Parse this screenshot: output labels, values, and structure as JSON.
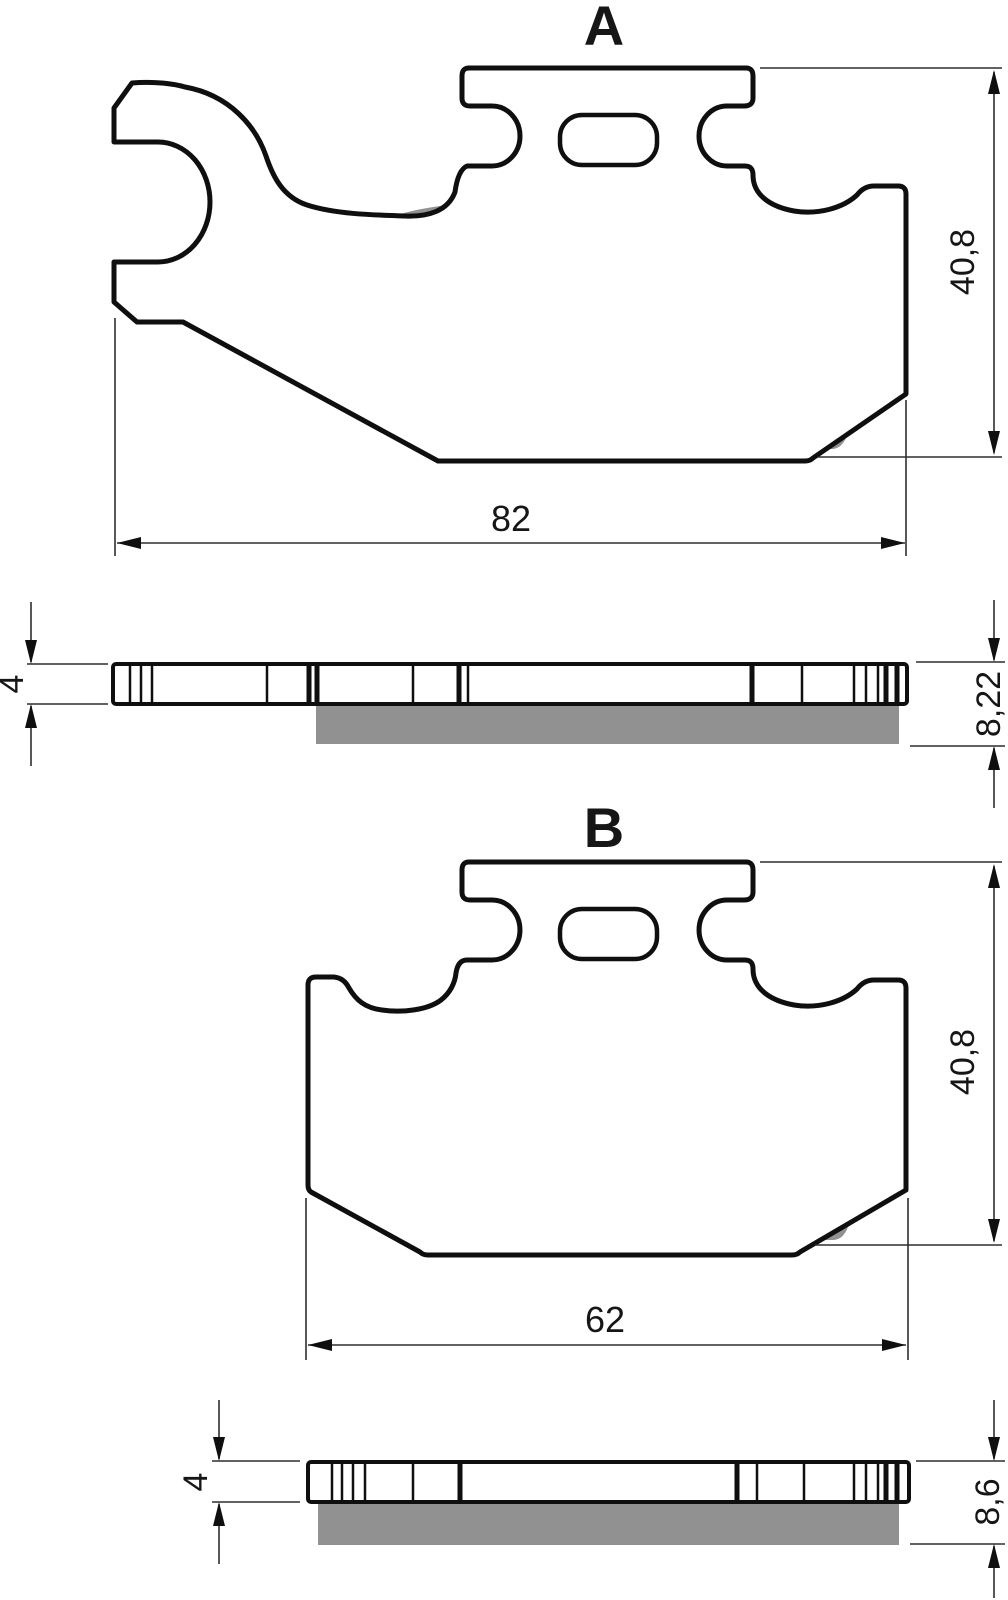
{
  "figure_labels": {
    "a": "A",
    "b": "B"
  },
  "dimensions": {
    "a": {
      "width": "82",
      "height": "40,8",
      "plate_thickness": "4",
      "total_thickness": "8,22"
    },
    "b": {
      "width": "62",
      "height": "40,8",
      "plate_thickness": "4",
      "total_thickness": "8,6"
    }
  },
  "colors": {
    "outline": "#0f0f0f",
    "friction": "#919191",
    "dim": "#2e2e2e",
    "bg": "#ffffff"
  }
}
